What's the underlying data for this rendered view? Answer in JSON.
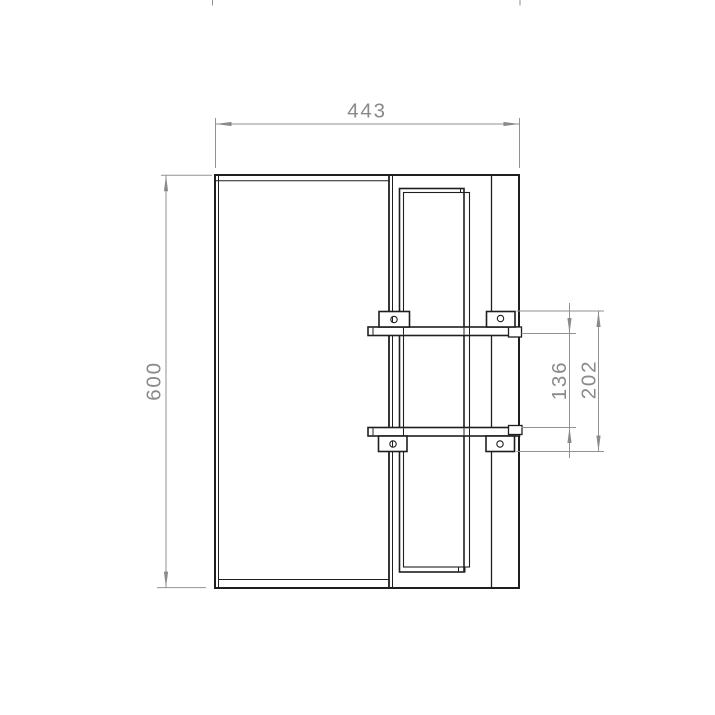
{
  "drawing": {
    "kind": "technical-elevation-drawing",
    "background": "#ffffff",
    "outline_color": "#1f1f1f",
    "dimension_color": "#8a8a8a",
    "dimensions": [
      {
        "id": "overall-width",
        "label": "443",
        "orientation": "horizontal",
        "position": "top"
      },
      {
        "id": "overall-height",
        "label": "600",
        "orientation": "vertical",
        "position": "left"
      },
      {
        "id": "rail-spacing-inner",
        "label": "136",
        "orientation": "vertical",
        "position": "right"
      },
      {
        "id": "rail-spacing-outer",
        "label": "202",
        "orientation": "vertical",
        "position": "right"
      }
    ]
  }
}
